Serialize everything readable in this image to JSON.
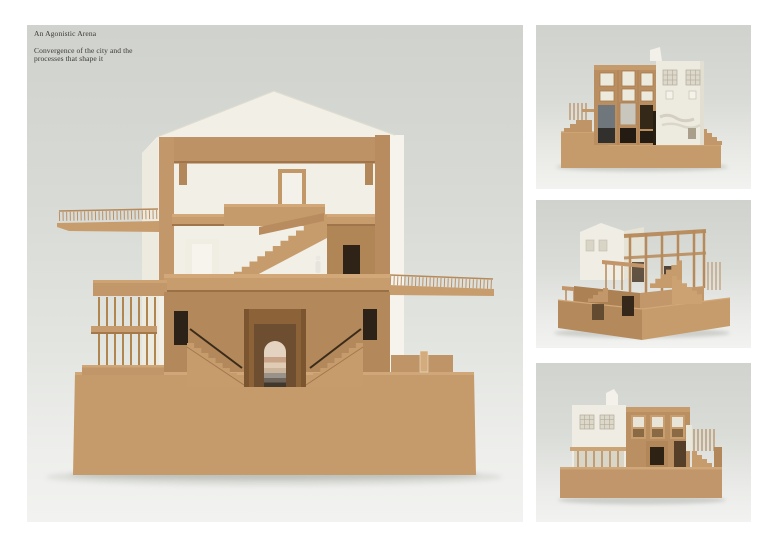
{
  "page": {
    "title": "An Agonistic Arena",
    "subtitle_line1": "Convergence of the city and the",
    "subtitle_line2": "processes that shape it"
  },
  "photos": {
    "main": {
      "alt": "Sectional model, front elevation: three-storey timber-framed hall with gabled white roof, cantilevered balconies, central arched undercroft with twin stairs on a solid plinth"
    },
    "thumb1": {
      "alt": "Model elevation: timber facade with glazed openings beside white plastered wall on a stepped plinth"
    },
    "thumb2": {
      "alt": "Model three-quarter view: post-and-beam timber frame and white gabled volume on a stepped plinth"
    },
    "thumb3": {
      "alt": "Model side elevation: white volume with gridded windows, timber window wall, porch and stair on a plinth"
    }
  },
  "palette": {
    "page_background": "#ffffff",
    "backdrop_top": "#cfd2cd",
    "backdrop_bottom": "#f2f3f0",
    "cardboard": "#c59b6c",
    "cardboard_dark": "#8c6339",
    "model_white": "#f2efe7",
    "text": "#3b3733"
  }
}
